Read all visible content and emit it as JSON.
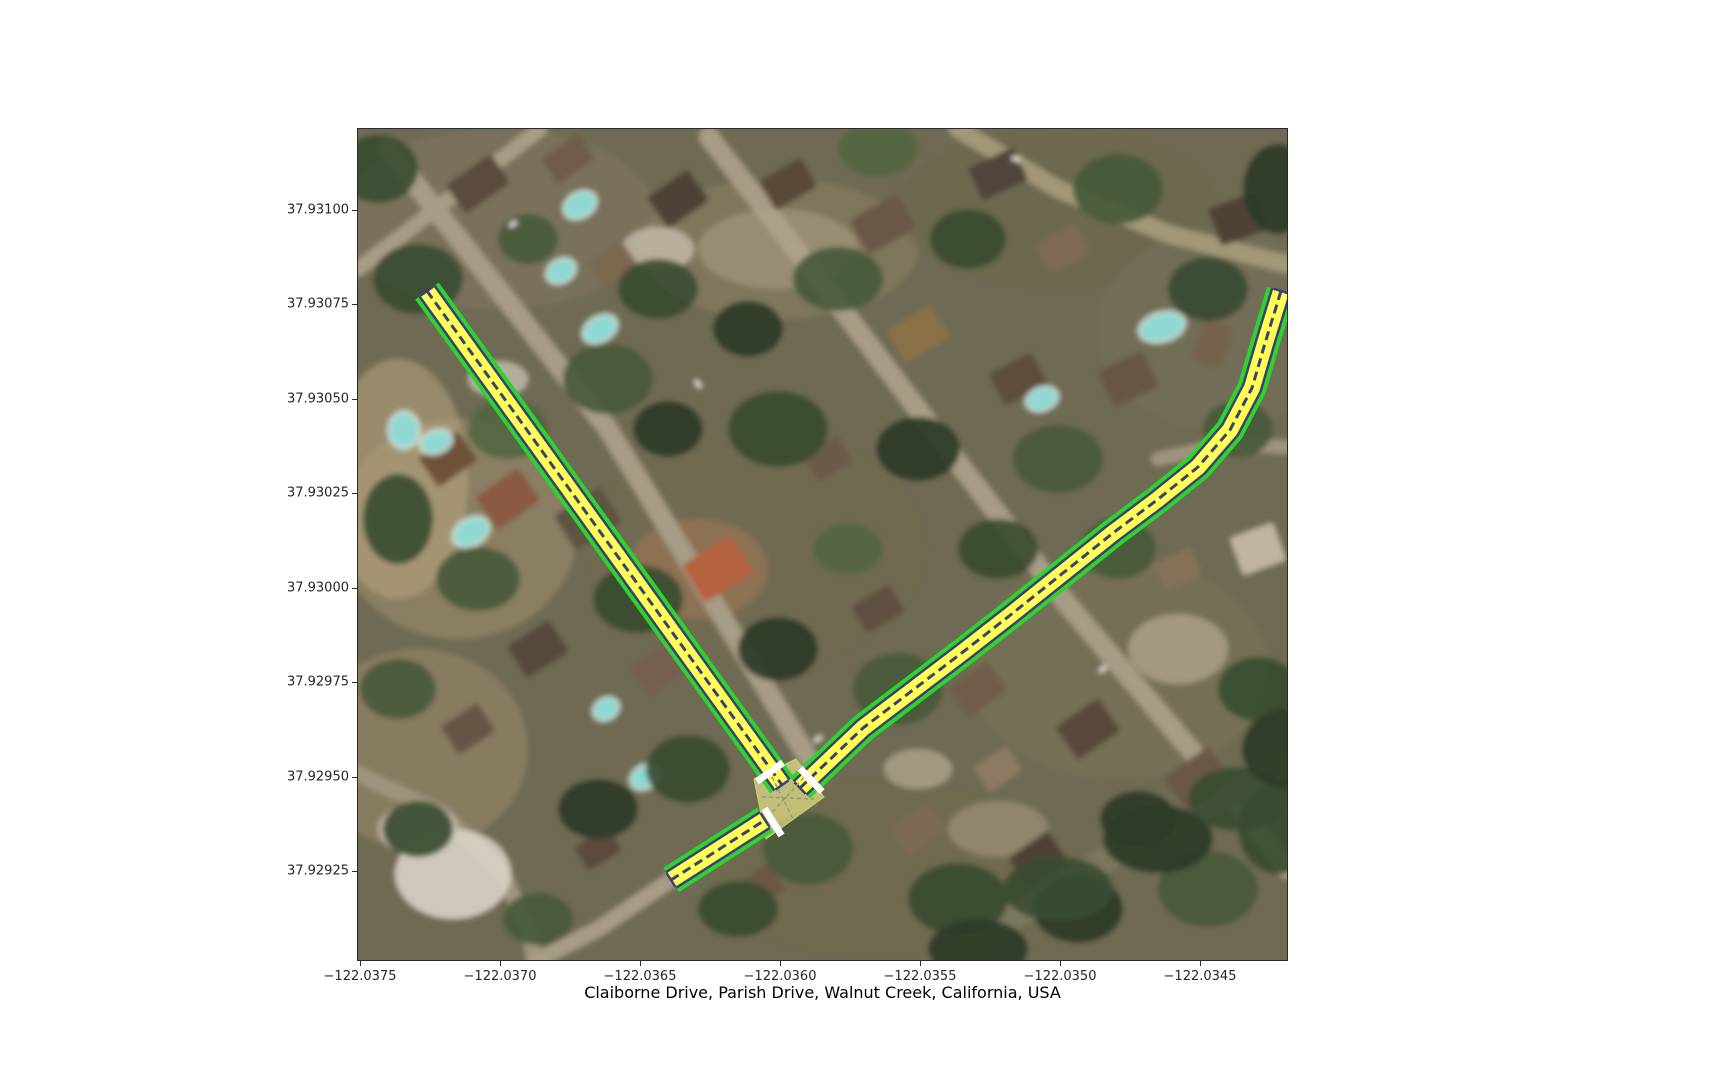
{
  "figure": {
    "title": "Claiborne Drive, Parish Drive, Walnut Creek, California, USA",
    "background": "#ffffff",
    "axes_box": {
      "left": 358,
      "top": 129,
      "width": 929,
      "height": 831
    },
    "axes_border_color": "#2b2b2b"
  },
  "axes": {
    "y_ticks": [
      {
        "label": "37.93100",
        "py": 81
      },
      {
        "label": "37.93075",
        "py": 175
      },
      {
        "label": "37.93050",
        "py": 270
      },
      {
        "label": "37.93025",
        "py": 364
      },
      {
        "label": "37.93000",
        "py": 459
      },
      {
        "label": "37.92975",
        "py": 553
      },
      {
        "label": "37.92950",
        "py": 648
      },
      {
        "label": "37.92925",
        "py": 742
      }
    ],
    "x_ticks": [
      {
        "label": "−122.0375",
        "px": 2
      },
      {
        "label": "−122.0370",
        "px": 142
      },
      {
        "label": "−122.0365",
        "px": 282
      },
      {
        "label": "−122.0360",
        "px": 422
      },
      {
        "label": "−122.0355",
        "px": 562
      },
      {
        "label": "−122.0350",
        "px": 702
      },
      {
        "label": "−122.0345",
        "px": 842
      }
    ]
  },
  "map_overlay": {
    "colors": {
      "casing": "#2ED32E",
      "edge": "#3E3E76",
      "fill": "#FFFF55",
      "lane_line": "#3E3E76",
      "stop_line": "#FFFFFF",
      "junction_fill": "rgba(248,248,150,0.6)",
      "junction_stroke": "#CFCF6E",
      "connector": "#9A9A70"
    },
    "widths": {
      "casing": 29,
      "edge": 21,
      "fill": 16,
      "lane_line": 3,
      "cap": 2.5,
      "cap_len": 16
    },
    "roads": [
      {
        "name": "claiborne-drive",
        "points": [
          [
            69,
            162
          ],
          [
            424,
            656
          ]
        ]
      },
      {
        "name": "claiborne-sw-stub",
        "points": [
          [
            313,
            751
          ],
          [
            407,
            691
          ]
        ]
      },
      {
        "name": "parish-drive",
        "points": [
          [
            442,
            659
          ],
          [
            505,
            599
          ],
          [
            555,
            561
          ],
          [
            605,
            523
          ],
          [
            655,
            484
          ],
          [
            705,
            444
          ],
          [
            755,
            404
          ],
          [
            799,
            371
          ],
          [
            840,
            338
          ],
          [
            872,
            301
          ],
          [
            894,
            259
          ],
          [
            908,
            211
          ],
          [
            923,
            162
          ]
        ]
      }
    ],
    "junction": {
      "polygon": [
        [
          396,
          650
        ],
        [
          438,
          630
        ],
        [
          466,
          668
        ],
        [
          408,
          710
        ]
      ],
      "connectors": [
        [
          [
            414,
            648
          ],
          [
            436,
            692
          ]
        ],
        [
          [
            404,
            668
          ],
          [
            456,
            670
          ]
        ],
        [
          [
            410,
            688
          ],
          [
            448,
            646
          ]
        ]
      ]
    },
    "stop_lines": [
      {
        "cx": 412,
        "cy": 643,
        "angle": 144.3,
        "len": 32,
        "thick": 7
      },
      {
        "cx": 415,
        "cy": 693,
        "angle": 57.5,
        "len": 32,
        "thick": 7
      },
      {
        "cx": 453,
        "cy": 651,
        "angle": 46.4,
        "len": 32,
        "thick": 7
      }
    ]
  },
  "scene": {
    "base_color": "#6E6B52",
    "ground_blobs": [
      [
        140,
        90,
        160,
        90,
        "#7E7460",
        0.7
      ],
      [
        420,
        120,
        140,
        70,
        "#8A7E62",
        0.6
      ],
      [
        700,
        80,
        160,
        80,
        "#6A6850",
        0.6
      ],
      [
        100,
        400,
        120,
        110,
        "#A3906F",
        0.55
      ],
      [
        60,
        620,
        110,
        100,
        "#97876B",
        0.6
      ],
      [
        400,
        420,
        170,
        120,
        "#6F6A50",
        0.5
      ],
      [
        760,
        540,
        150,
        110,
        "#7C7258",
        0.55
      ],
      [
        520,
        740,
        170,
        90,
        "#716B50",
        0.6
      ],
      [
        860,
        200,
        120,
        100,
        "#75705A",
        0.5
      ],
      [
        40,
        350,
        70,
        120,
        "#B9A581",
        0.55
      ],
      [
        340,
        440,
        70,
        50,
        "#C47E5A",
        0.35
      ]
    ],
    "streets": [
      {
        "pts": [
          [
            30,
            20
          ],
          [
            250,
            300
          ],
          [
            460,
            645
          ]
        ],
        "w": 20,
        "color": "#A79C85"
      },
      {
        "pts": [
          [
            351,
            8
          ],
          [
            480,
            175
          ],
          [
            595,
            327
          ],
          [
            705,
            470
          ],
          [
            815,
            600
          ],
          [
            900,
            700
          ],
          [
            929,
            740
          ]
        ],
        "w": 20,
        "color": "#A79C85"
      },
      {
        "pts": [
          [
            800,
            330
          ],
          [
            870,
            315
          ],
          [
            928,
            318
          ]
        ],
        "w": 14,
        "color": "#9E947D"
      },
      {
        "pts": [
          [
            600,
            0
          ],
          [
            700,
            60
          ],
          [
            810,
            105
          ],
          [
            915,
            132
          ],
          [
            929,
            135
          ]
        ],
        "w": 18,
        "color": "#A29878"
      },
      {
        "pts": [
          [
            588,
            831
          ],
          [
            740,
            735
          ],
          [
            929,
            635
          ]
        ],
        "w": 26,
        "color": "#7A775E"
      },
      {
        "pts": [
          [
            0,
            645
          ],
          [
            85,
            685
          ],
          [
            145,
            745
          ],
          [
            172,
            805
          ],
          [
            176,
            831
          ]
        ],
        "w": 16,
        "color": "#9E947D"
      },
      {
        "pts": [
          [
            0,
            140
          ],
          [
            182,
            0
          ]
        ],
        "w": 15,
        "color": "#A79C85"
      },
      {
        "pts": [
          [
            313,
            751
          ],
          [
            240,
            800
          ],
          [
            180,
            831
          ]
        ],
        "w": 16,
        "color": "#A79C85"
      }
    ],
    "patches": [
      [
        95,
        745,
        58,
        45,
        "#D8D3C6",
        0.9
      ],
      [
        60,
        700,
        40,
        26,
        "#C9C2B2",
        0.8
      ],
      [
        420,
        120,
        80,
        40,
        "#B5A98D",
        0.45
      ],
      [
        640,
        700,
        50,
        28,
        "#AFA287",
        0.5
      ],
      [
        820,
        520,
        50,
        35,
        "#C6BCA4",
        0.55
      ],
      [
        300,
        120,
        36,
        22,
        "#CFC8B8",
        0.7
      ],
      [
        560,
        640,
        34,
        20,
        "#C2B89F",
        0.6
      ],
      [
        140,
        250,
        30,
        18,
        "#D2CCBC",
        0.7
      ]
    ],
    "houses": [
      [
        120,
        55,
        55,
        35,
        -35,
        "#5A4C3C"
      ],
      [
        210,
        30,
        45,
        30,
        -35,
        "#6E5C48"
      ],
      [
        320,
        70,
        50,
        38,
        -35,
        "#4E4234"
      ],
      [
        255,
        135,
        40,
        30,
        -35,
        "#7A6850"
      ],
      [
        430,
        55,
        48,
        34,
        -30,
        "#594A39"
      ],
      [
        525,
        95,
        55,
        40,
        -30,
        "#6B5947"
      ],
      [
        640,
        45,
        50,
        36,
        -25,
        "#50453A"
      ],
      [
        705,
        120,
        46,
        34,
        -28,
        "#7E6B52"
      ],
      [
        560,
        205,
        52,
        38,
        -30,
        "#8A7047"
      ],
      [
        660,
        250,
        48,
        36,
        -28,
        "#5C4E3E"
      ],
      [
        770,
        250,
        50,
        40,
        -25,
        "#685745"
      ],
      [
        855,
        215,
        44,
        32,
        -70,
        "#74634E"
      ],
      [
        880,
        90,
        50,
        40,
        -20,
        "#4F4335"
      ],
      [
        150,
        370,
        52,
        40,
        -35,
        "#8A5A42"
      ],
      [
        90,
        330,
        48,
        36,
        -35,
        "#6E5139"
      ],
      [
        230,
        390,
        55,
        42,
        -32,
        "#5F5242"
      ],
      [
        360,
        440,
        58,
        44,
        -32,
        "#B4623F"
      ],
      [
        470,
        330,
        40,
        30,
        -32,
        "#6A5A48"
      ],
      [
        180,
        520,
        50,
        38,
        -33,
        "#55483A"
      ],
      [
        300,
        540,
        46,
        36,
        -33,
        "#746150"
      ],
      [
        110,
        600,
        44,
        34,
        -33,
        "#665544"
      ],
      [
        520,
        480,
        44,
        32,
        -30,
        "#5E4F40"
      ],
      [
        620,
        560,
        48,
        36,
        -35,
        "#6F5D4A"
      ],
      [
        730,
        600,
        52,
        40,
        -35,
        "#59493B"
      ],
      [
        840,
        650,
        55,
        42,
        -35,
        "#6B5946"
      ],
      [
        560,
        700,
        46,
        34,
        -35,
        "#7B6953"
      ],
      [
        680,
        730,
        48,
        36,
        -35,
        "#4F4336"
      ],
      [
        900,
        420,
        46,
        40,
        -20,
        "#C0B5A0"
      ],
      [
        820,
        440,
        40,
        30,
        -25,
        "#857158"
      ],
      [
        640,
        640,
        40,
        30,
        -35,
        "#8C7A62"
      ],
      [
        400,
        760,
        46,
        32,
        -35,
        "#6A5845"
      ],
      [
        240,
        720,
        40,
        28,
        -33,
        "#5C4C3E"
      ]
    ],
    "tree_palette": [
      "#2C3B28",
      "#3A4C31",
      "#48593A",
      "#556641"
    ],
    "trees": [
      [
        60,
        150,
        45,
        35,
        1
      ],
      [
        170,
        110,
        30,
        25,
        2
      ],
      [
        300,
        160,
        40,
        30,
        1
      ],
      [
        390,
        200,
        35,
        28,
        0
      ],
      [
        480,
        150,
        45,
        32,
        2
      ],
      [
        610,
        110,
        38,
        30,
        1
      ],
      [
        760,
        60,
        45,
        35,
        2
      ],
      [
        850,
        160,
        40,
        32,
        1
      ],
      [
        920,
        60,
        35,
        45,
        0
      ],
      [
        250,
        250,
        45,
        35,
        2
      ],
      [
        420,
        300,
        50,
        38,
        1
      ],
      [
        560,
        320,
        42,
        32,
        0
      ],
      [
        700,
        330,
        45,
        34,
        2
      ],
      [
        640,
        420,
        40,
        30,
        1
      ],
      [
        760,
        420,
        38,
        30,
        2
      ],
      [
        310,
        300,
        35,
        28,
        0
      ],
      [
        150,
        300,
        40,
        30,
        3
      ],
      [
        40,
        390,
        35,
        45,
        1
      ],
      [
        120,
        450,
        42,
        32,
        2
      ],
      [
        280,
        470,
        45,
        34,
        1
      ],
      [
        420,
        520,
        40,
        32,
        0
      ],
      [
        540,
        560,
        45,
        36,
        2
      ],
      [
        330,
        640,
        42,
        34,
        1
      ],
      [
        240,
        680,
        40,
        30,
        0
      ],
      [
        450,
        720,
        45,
        36,
        2
      ],
      [
        600,
        770,
        50,
        36,
        1
      ],
      [
        720,
        780,
        45,
        34,
        0
      ],
      [
        850,
        760,
        50,
        38,
        2
      ],
      [
        900,
        560,
        40,
        32,
        1
      ],
      [
        40,
        560,
        38,
        30,
        2
      ],
      [
        60,
        700,
        35,
        28,
        1
      ],
      [
        880,
        300,
        35,
        28,
        2
      ],
      [
        490,
        420,
        35,
        26,
        3
      ],
      [
        380,
        780,
        40,
        28,
        1
      ],
      [
        180,
        790,
        35,
        26,
        2
      ],
      [
        780,
        690,
        38,
        28,
        0
      ],
      [
        920,
        700,
        40,
        45,
        1
      ],
      [
        620,
        820,
        50,
        30,
        0
      ],
      [
        700,
        760,
        55,
        32,
        1
      ],
      [
        800,
        710,
        55,
        34,
        0
      ],
      [
        880,
        670,
        50,
        32,
        1
      ],
      [
        929,
        620,
        45,
        40,
        0
      ],
      [
        520,
        20,
        40,
        28,
        3
      ],
      [
        20,
        40,
        40,
        34,
        1
      ]
    ],
    "pools": [
      [
        222,
        76,
        16,
        11,
        -30
      ],
      [
        203,
        142,
        14,
        10,
        -30
      ],
      [
        242,
        200,
        17,
        11,
        -30
      ],
      [
        804,
        198,
        22,
        13,
        -15
      ],
      [
        684,
        270,
        15,
        10,
        -20
      ],
      [
        113,
        403,
        18,
        12,
        -30
      ],
      [
        46,
        301,
        14,
        17,
        0
      ],
      [
        287,
        648,
        14,
        10,
        -30
      ],
      [
        248,
        580,
        12,
        9,
        -30
      ],
      [
        78,
        313,
        15,
        10,
        -20
      ]
    ],
    "pool_color": "#8FD9D2",
    "pool_ring": "#DDEDE6",
    "cars": [
      [
        155,
        95,
        9,
        4,
        -35
      ],
      [
        340,
        255,
        9,
        4,
        55
      ],
      [
        745,
        540,
        9,
        4,
        -40
      ],
      [
        460,
        610,
        9,
        4,
        -35
      ],
      [
        658,
        30,
        9,
        4,
        20
      ]
    ]
  }
}
